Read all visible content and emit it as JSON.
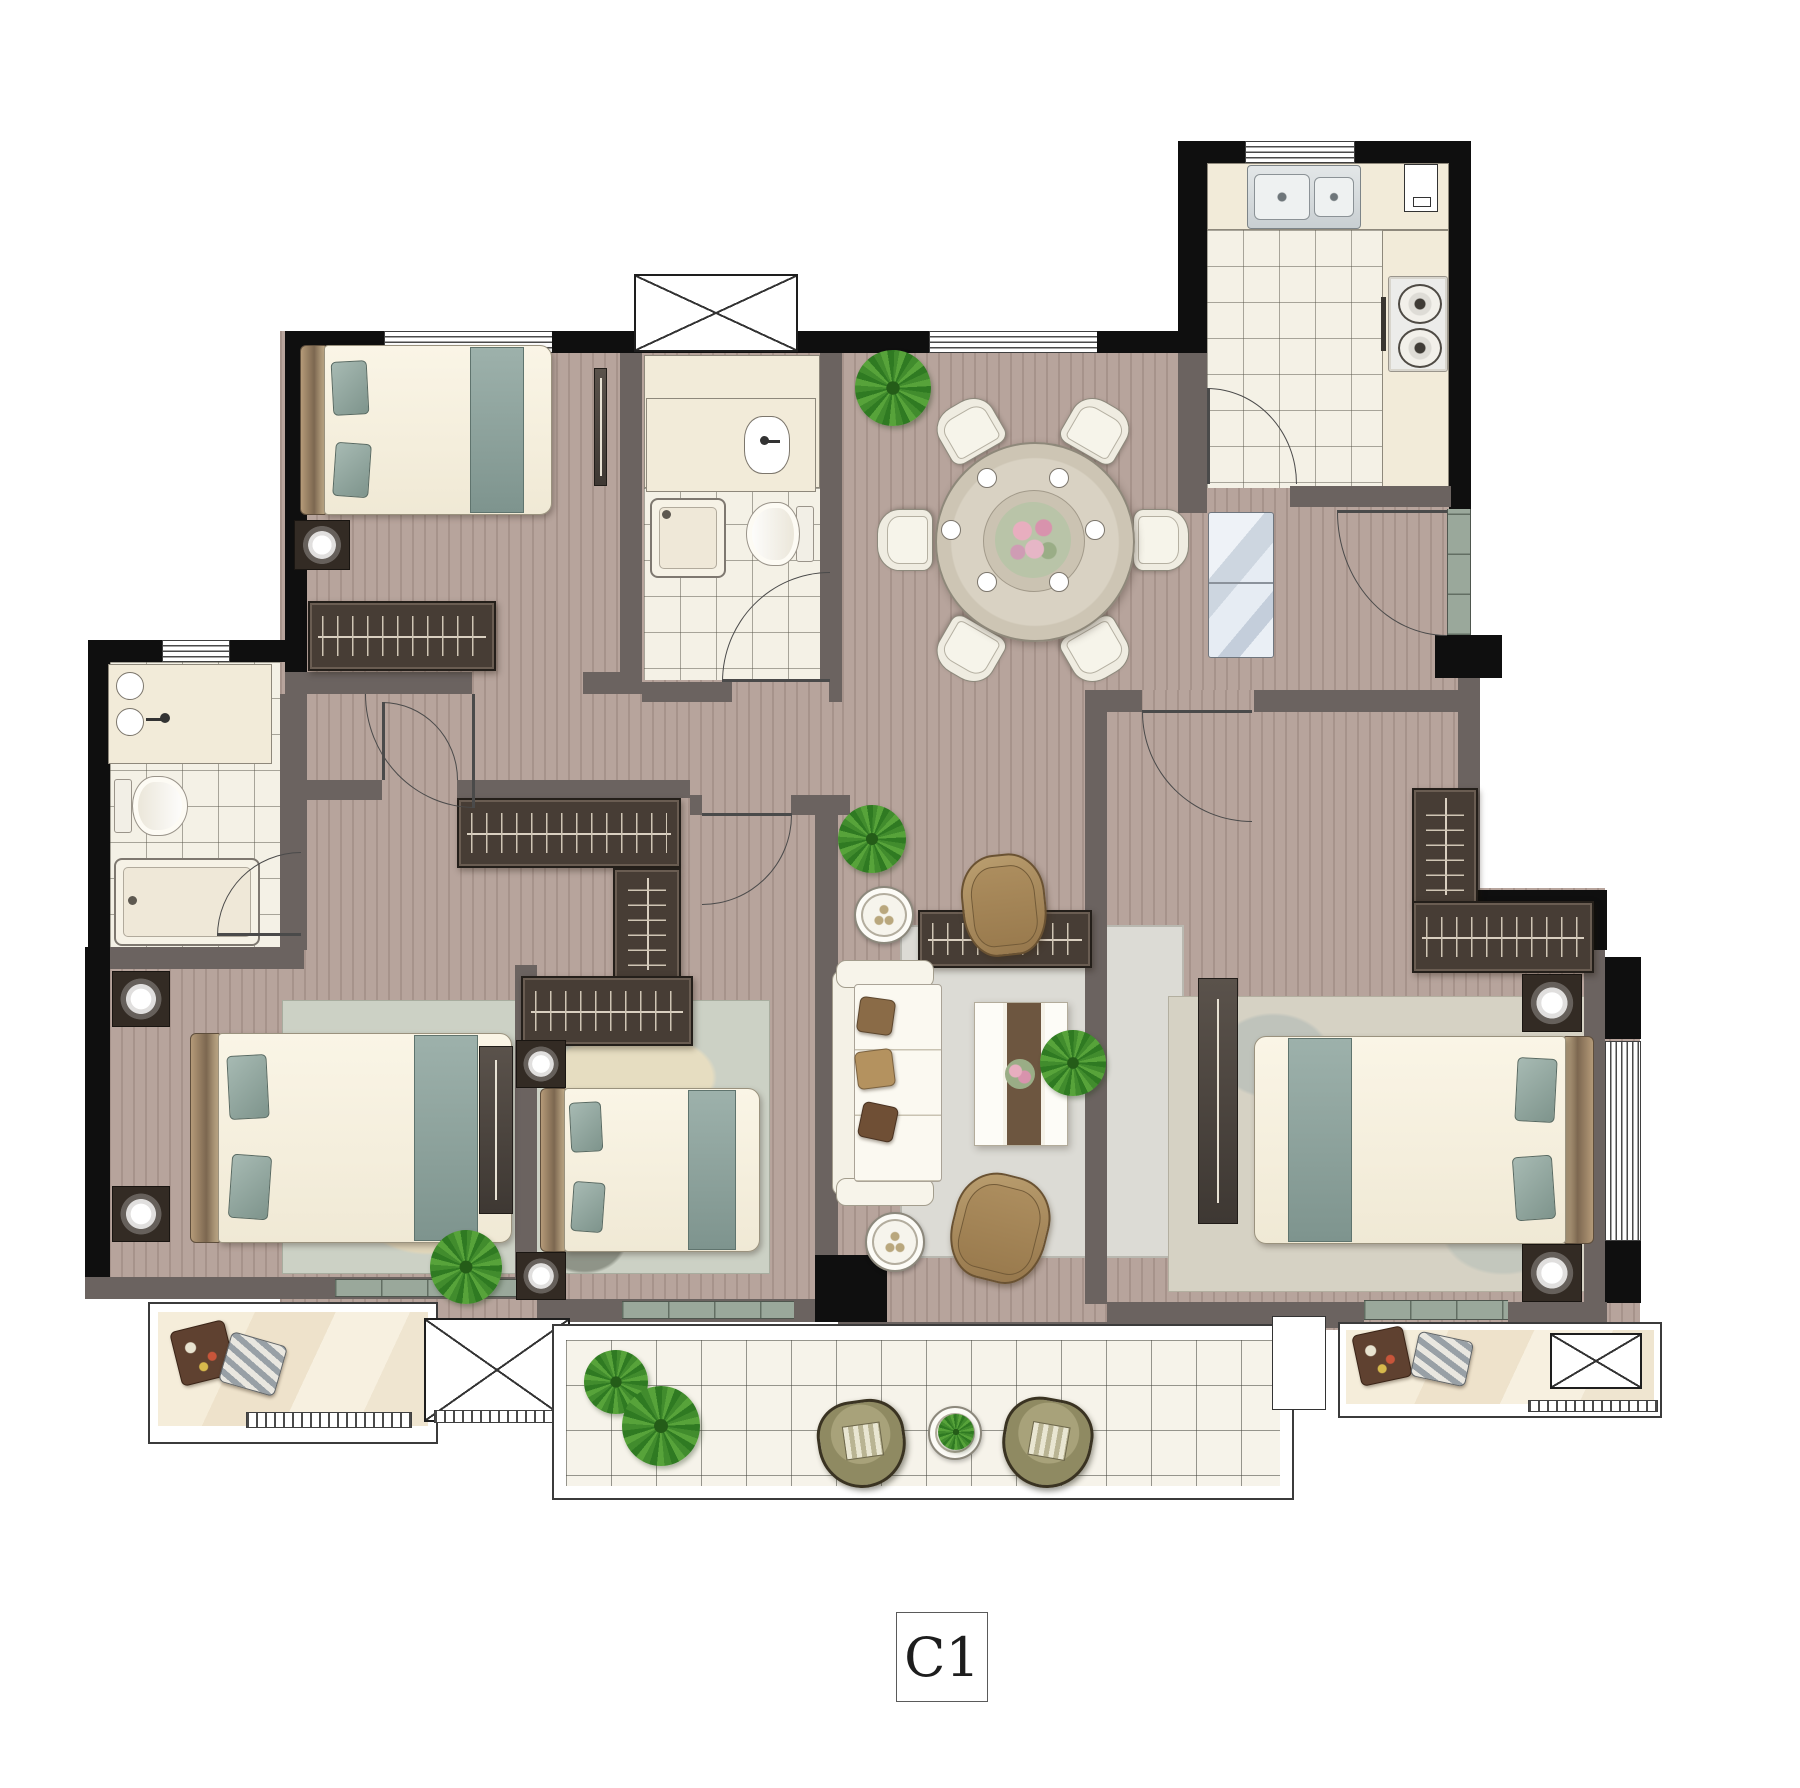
{
  "unit_label": "C1",
  "plan": {
    "type": "residential-apartment-floor-plan",
    "rooms": [
      {
        "name": "bedroom-top-left",
        "furniture": [
          "double-bed",
          "nightstand-lamp",
          "wardrobe",
          "tv-panel",
          "window"
        ]
      },
      {
        "name": "bathroom-center",
        "furniture": [
          "vanity-sink",
          "toilet",
          "shower",
          "duct-shaft"
        ]
      },
      {
        "name": "dining-room",
        "furniture": [
          "round-table",
          "six-chairs",
          "place-settings",
          "flower-centerpiece",
          "plant"
        ]
      },
      {
        "name": "kitchen",
        "furniture": [
          "double-sink",
          "gas-stove",
          "counter",
          "appliance",
          "window",
          "door"
        ]
      },
      {
        "name": "entry-hall",
        "furniture": [
          "refrigerator",
          "entry-door",
          "threshold"
        ]
      },
      {
        "name": "ensuite-bathroom-left",
        "furniture": [
          "vanity-two-sinks",
          "toilet",
          "shower",
          "window"
        ]
      },
      {
        "name": "master-bedroom",
        "furniture": [
          "double-bed",
          "two-nightstand-lamps",
          "rug",
          "tv-console",
          "plant"
        ]
      },
      {
        "name": "bedroom-middle",
        "furniture": [
          "double-bed",
          "two-nightstand-lamps",
          "wardrobes"
        ]
      },
      {
        "name": "living-room",
        "furniture": [
          "sofa",
          "two-armchairs",
          "coffee-table",
          "two-side-tables",
          "rug",
          "media-cabinet",
          "plants"
        ]
      },
      {
        "name": "bedroom-right",
        "furniture": [
          "double-bed",
          "two-nightstand-lamps",
          "l-shaped-wardrobe",
          "tv-console",
          "rug",
          "bay-window"
        ]
      },
      {
        "name": "balcony-left",
        "furniture": [
          "cushions",
          "railing"
        ]
      },
      {
        "name": "balcony-main",
        "furniture": [
          "two-lounge-chairs",
          "round-table",
          "plants"
        ]
      },
      {
        "name": "balcony-right",
        "furniture": [
          "cushions",
          "duct-shaft",
          "railing"
        ]
      }
    ],
    "symbols": [
      "door-swing-arcs",
      "x-duct-shafts",
      "hatched-windows",
      "sliding-door-thresholds"
    ]
  },
  "colors": {
    "floor_wood": "#b7a49c",
    "tile": "#f4f1e6",
    "wall_exterior": "#0f0f0f",
    "wall_interior": "#6b6360",
    "counter_cream": "#f2ebd9",
    "accent_teal": "#8ea49e",
    "rug_sage": "#ccd1c5",
    "chair_tan": "#a8895c",
    "plant_green": "#418c2d",
    "threshold_marble": "#9aa89b"
  }
}
